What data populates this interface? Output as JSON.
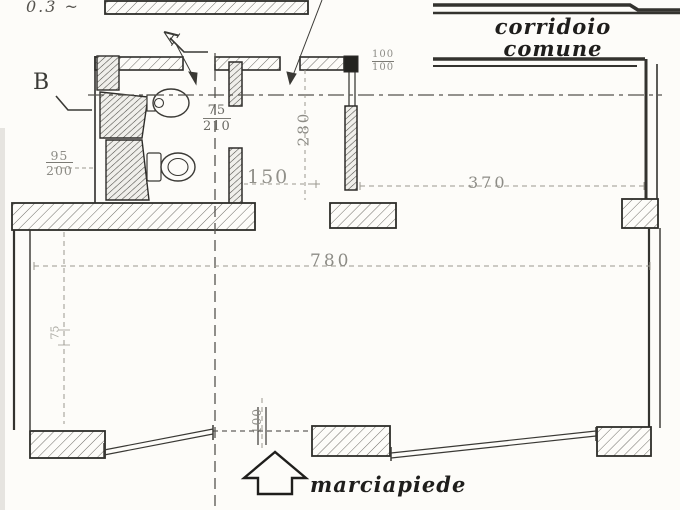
{
  "labels": {
    "corridor_line1": "corridoio",
    "corridor_line2": "comune",
    "sidewalk": "marciapiede",
    "top_left_fragment": "0.3 ~",
    "marker_a": "A",
    "marker_b": "B"
  },
  "dimensions": {
    "corridor_width": "370",
    "storefront_width": "780",
    "bath_passage": "150",
    "bath_depth": "280",
    "interior_door_w": "75",
    "interior_door_h": "210",
    "left_window_w": "95",
    "left_window_h": "200",
    "top_window_w": "100",
    "top_window_h": "100",
    "entrance_door": "100",
    "left_side": "75"
  },
  "colors": {
    "ink": "#2e2d2a",
    "faint_ink": "#8d8c86",
    "paper": "#fdfcf9"
  }
}
